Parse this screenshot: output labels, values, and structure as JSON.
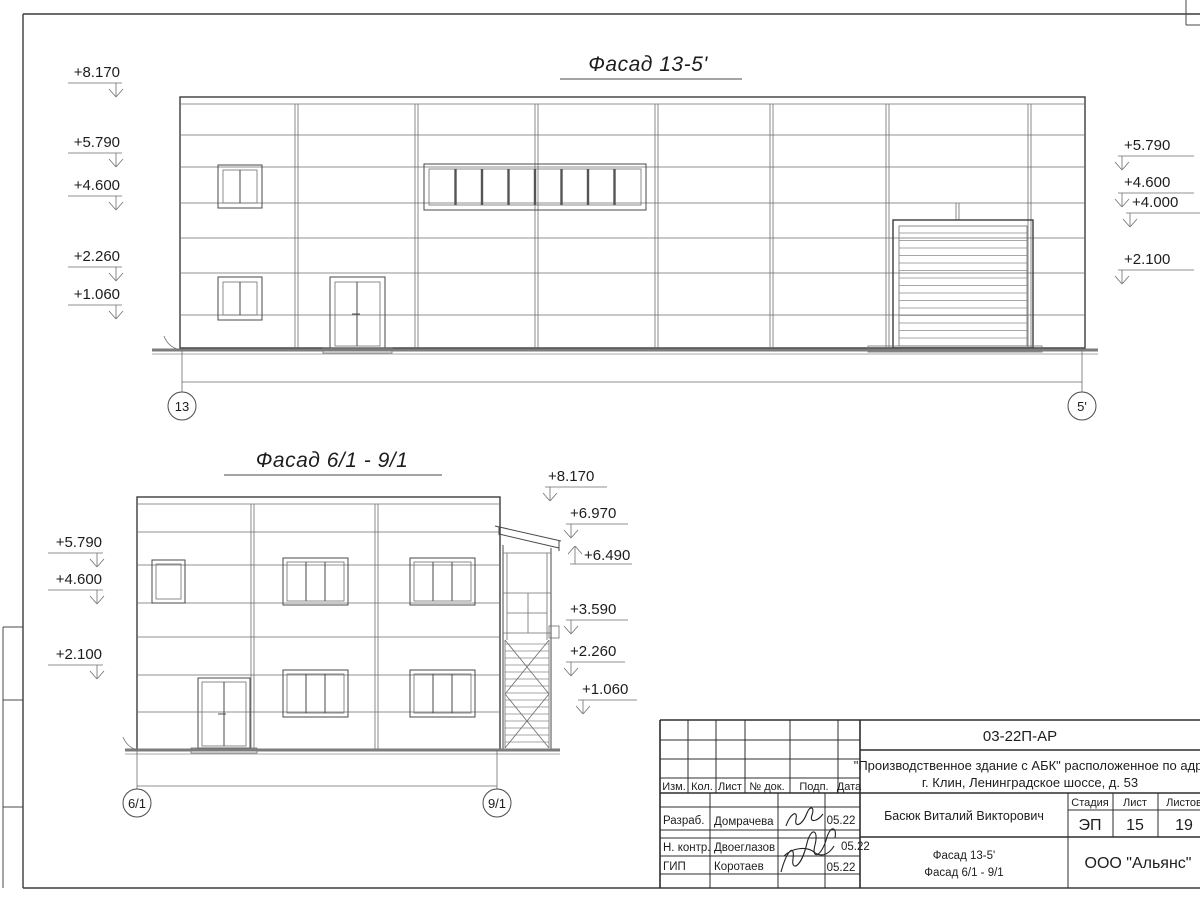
{
  "facade1": {
    "title": "Фасад 13-5'",
    "axis_left": "13",
    "axis_right": "5'",
    "marks_left": [
      "+8.170",
      "+5.790",
      "+4.600",
      "+2.260",
      "+1.060"
    ],
    "marks_right": [
      "+5.790",
      "+4.600",
      "+4.000",
      "+2.100"
    ]
  },
  "facade2": {
    "title": "Фасад 6/1 - 9/1",
    "axis_left": "6/1",
    "axis_right": "9/1",
    "marks_left": [
      "+5.790",
      "+4.600",
      "+2.100"
    ],
    "marks_right": [
      "+8.170",
      "+6.970",
      "+6.490",
      "+3.590",
      "+2.260",
      "+1.060"
    ]
  },
  "title_block": {
    "code": "03-22П-АР",
    "project_line1": "\"Производственное здание с АБК\" расположенное по адресу:",
    "project_line2": "г. Клин, Ленинградское шоссе, д. 53",
    "columns": {
      "izm": "Изм.",
      "kol": "Кол.",
      "list": "Лист",
      "doc": "№ док.",
      "sign": "Подп.",
      "date": "Дата"
    },
    "rows": [
      {
        "role": "Разраб.",
        "name": "Домрачева",
        "date": "05.22"
      },
      {
        "role": "Н. контр.",
        "name": "Двоеглазов",
        "date": "05.22"
      },
      {
        "role": "ГИП",
        "name": "Коротаев",
        "date": "05.22"
      }
    ],
    "approver": "Басюк Виталий Викторович",
    "stage_label": "Стадия",
    "sheet_label": "Лист",
    "sheets_label": "Листов",
    "stage": "ЭП",
    "sheet_no": "15",
    "sheets_total": "19",
    "drawing_line1": "Фасад 13-5'",
    "drawing_line2": "Фасад 6/1 - 9/1",
    "company": "ООО \"Альянс\""
  }
}
